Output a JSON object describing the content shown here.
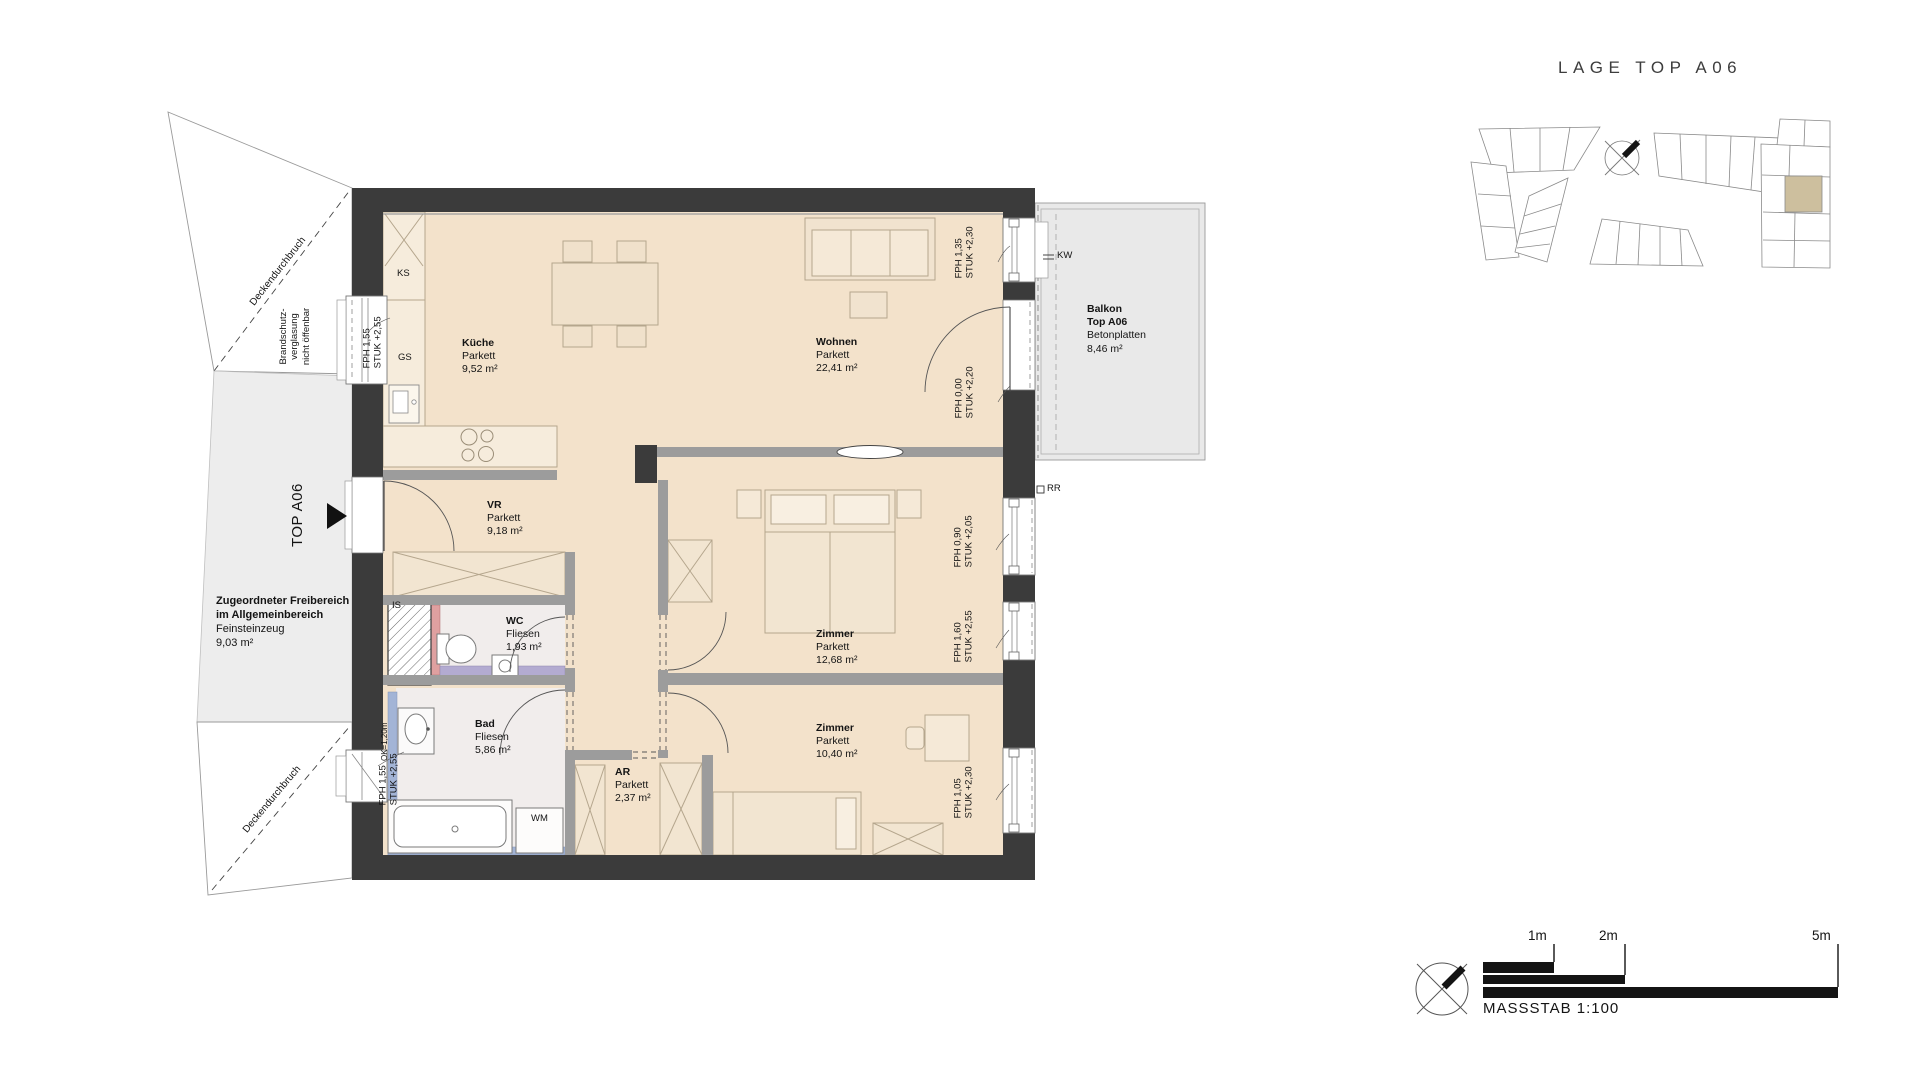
{
  "site_plan": {
    "title": "LAGE TOP A06"
  },
  "entry": {
    "label": "TOP A06"
  },
  "rooms": {
    "kueche": {
      "name": "Küche",
      "finish": "Parkett",
      "area": "9,52 m²"
    },
    "wohnen": {
      "name": "Wohnen",
      "finish": "Parkett",
      "area": "22,41 m²"
    },
    "vr": {
      "name": "VR",
      "finish": "Parkett",
      "area": "9,18 m²"
    },
    "wc": {
      "name": "WC",
      "finish": "Fliesen",
      "area": "1,93 m²"
    },
    "bad": {
      "name": "Bad",
      "finish": "Fliesen",
      "area": "5,86 m²"
    },
    "ar": {
      "name": "AR",
      "finish": "Parkett",
      "area": "2,37 m²"
    },
    "zimmer1": {
      "name": "Zimmer",
      "finish": "Parkett",
      "area": "12,68 m²"
    },
    "zimmer2": {
      "name": "Zimmer",
      "finish": "Parkett",
      "area": "10,40 m²"
    }
  },
  "balcony": {
    "name": "Balkon",
    "unit": "Top A06",
    "finish": "Betonplatten",
    "area": "8,46 m²"
  },
  "outdoor": {
    "line1": "Zugeordneter Freibereich",
    "line2": "im Allgemeinbereich",
    "line3": "Feinsteinzeug",
    "line4": "9,03 m²"
  },
  "windows": {
    "kueche": {
      "l1": "FPH 1,55",
      "l2": "STUK +2,55"
    },
    "bad": {
      "l1": "FPH 1,55",
      "l2": "STUK +2,55"
    },
    "wohnen": {
      "l1": "FPH 1,35",
      "l2": "STUK +2,30"
    },
    "balkontuer": {
      "l1": "FPH 0,00",
      "l2": "STUK +2,20"
    },
    "zimmer1a": {
      "l1": "FPH 0,90",
      "l2": "STUK +2,05"
    },
    "zimmer1b": {
      "l1": "FPH 1,60",
      "l2": "STUK +2,55"
    },
    "zimmer2": {
      "l1": "FPH 1,05",
      "l2": "STUK +2,30"
    }
  },
  "fixtures": {
    "ks": "KS",
    "gs": "GS",
    "is": "IS",
    "wm": "WM",
    "rr": "RR",
    "kw": "KW",
    "ok_height": "OK=1,20m"
  },
  "annotations": {
    "deckendurchbruch": "Deckendurchbruch",
    "brandschutz_l1": "Brandschutz-",
    "brandschutz_l2": "verglasung",
    "brandschutz_l3": "nicht öffenbar"
  },
  "scale_bar": {
    "m1": "1m",
    "m2": "2m",
    "m5": "5m",
    "caption": "MASSSTAB 1:100"
  },
  "colors": {
    "floor_parkett": "#f3e2cb",
    "wall_dark": "#3b3b3b",
    "wall_interior": "#9c9c9c",
    "balcony_gray": "#e9e9e9",
    "outdoor_gray": "#ededed",
    "bath_floor": "#f1edec",
    "strip_purple": "#b3abd1",
    "strip_pink": "#dfa0a0",
    "strip_blue": "#a3b4d6",
    "site_highlight": "#cdbf9e"
  }
}
